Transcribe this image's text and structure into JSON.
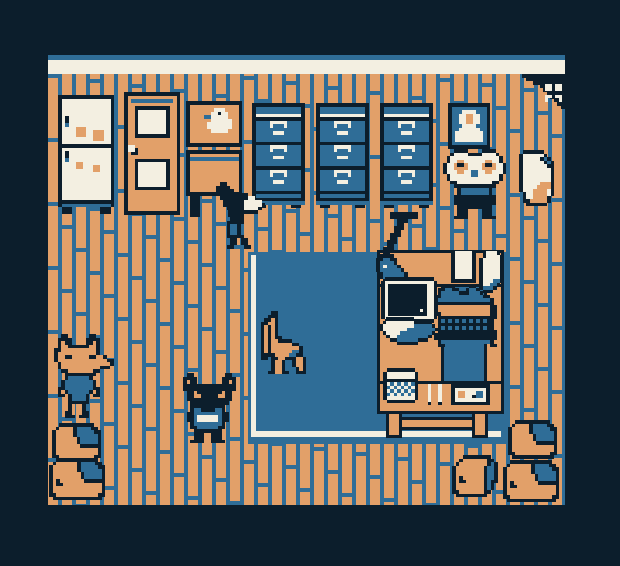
{
  "canvas": {
    "w": 620,
    "h": 566
  },
  "pixel": 3.5,
  "palette": {
    "navy": "#0c1e2c",
    "blue": "#2f6d97",
    "orange": "#e2a069",
    "cream": "#f3efe1"
  },
  "color_keys": {
    "N": "navy",
    "B": "blue",
    "O": "orange",
    "C": "cream"
  },
  "room": {
    "left": 48,
    "top": 74,
    "right": 565,
    "bottom": 505
  },
  "scene": [
    {
      "name": "wall-trim-top",
      "type": "rect",
      "x": 48,
      "y": 55,
      "w": 517,
      "h": 5,
      "color": "blue",
      "interactable": false
    },
    {
      "name": "wall-trim",
      "type": "rect",
      "x": 48,
      "y": 60,
      "w": 517,
      "h": 14,
      "color": "cream",
      "interactable": false
    },
    {
      "name": "floor",
      "type": "floor",
      "x": 48,
      "y": 74,
      "w": 517,
      "h": 431,
      "plank": 10,
      "gap": 4,
      "seam": 4,
      "len": 64,
      "phase": 23,
      "interactable": false
    },
    {
      "name": "corner-shadow",
      "type": "sprite",
      "sprite": "corner_shadow",
      "x": 522,
      "y": 74,
      "interactable": false
    },
    {
      "name": "moth",
      "type": "sprite",
      "sprite": "moth",
      "x": 541,
      "y": 84,
      "interactable": true
    },
    {
      "name": "rug",
      "type": "rects",
      "interactable": false,
      "parts": [
        {
          "name": "rug-base",
          "x": 248,
          "y": 252,
          "w": 258,
          "h": 192,
          "color": "blue"
        },
        {
          "name": "rug-border-left",
          "x": 251,
          "y": 255,
          "w": 5,
          "h": 177,
          "color": "cream"
        },
        {
          "name": "rug-border-bottom",
          "x": 251,
          "y": 431,
          "w": 250,
          "h": 6,
          "color": "cream"
        }
      ]
    },
    {
      "name": "fridge",
      "type": "sprite",
      "sprite": "fridge",
      "x": 58,
      "y": 95,
      "interactable": true
    },
    {
      "name": "door",
      "type": "sprite",
      "sprite": "door",
      "x": 124,
      "y": 92,
      "interactable": true
    },
    {
      "name": "side-table",
      "type": "sprite",
      "sprite": "side_table",
      "x": 186,
      "y": 150,
      "interactable": true
    },
    {
      "name": "goose-picture",
      "type": "sprite",
      "sprite": "duck_picture",
      "x": 186,
      "y": 101,
      "interactable": false
    },
    {
      "name": "file-cabinet-1",
      "type": "sprite",
      "sprite": "file_cabinet",
      "x": 252,
      "y": 103,
      "interactable": true
    },
    {
      "name": "file-cabinet-2",
      "type": "sprite",
      "sprite": "file_cabinet",
      "x": 316,
      "y": 103,
      "interactable": true
    },
    {
      "name": "file-cabinet-3",
      "type": "sprite",
      "sprite": "file_cabinet",
      "x": 380,
      "y": 103,
      "interactable": true
    },
    {
      "name": "portrait",
      "type": "sprite",
      "sprite": "portrait",
      "x": 448,
      "y": 103,
      "interactable": false
    },
    {
      "name": "rabbit-character",
      "type": "sprite",
      "sprite": "rabbit",
      "x": 443,
      "y": 149,
      "interactable": true
    },
    {
      "name": "paper-bag",
      "type": "sprite",
      "sprite": "paper_bag",
      "x": 519,
      "y": 150,
      "interactable": true
    },
    {
      "name": "sniffing-cat-character",
      "type": "sprite",
      "sprite": "sniff_cat",
      "x": 216,
      "y": 182,
      "interactable": true
    },
    {
      "name": "chair",
      "type": "sprite",
      "sprite": "chair",
      "x": 257,
      "y": 311,
      "interactable": true
    },
    {
      "name": "desk-footbar",
      "type": "brect",
      "x": 398,
      "y": 417,
      "w": 78,
      "h": 13,
      "interactable": false
    },
    {
      "name": "desk-leg-left",
      "type": "brect",
      "x": 386,
      "y": 411,
      "w": 16,
      "h": 27,
      "interactable": false
    },
    {
      "name": "desk-leg-right",
      "type": "brect",
      "x": 472,
      "y": 411,
      "w": 16,
      "h": 27,
      "interactable": false
    },
    {
      "name": "desk-top",
      "type": "brect",
      "x": 377,
      "y": 250,
      "w": 127,
      "h": 37,
      "interactable": true
    },
    {
      "name": "desk-left-arm",
      "type": "brect",
      "x": 377,
      "y": 284,
      "w": 67,
      "h": 100,
      "interactable": true
    },
    {
      "name": "desk-right-arm",
      "type": "brect",
      "x": 484,
      "y": 284,
      "w": 20,
      "h": 100,
      "interactable": true
    },
    {
      "name": "desk-bottom",
      "type": "brect",
      "x": 377,
      "y": 381,
      "w": 127,
      "h": 33,
      "interactable": true
    },
    {
      "name": "desk-lamp",
      "type": "sprite",
      "sprite": "lamp",
      "x": 376,
      "y": 212,
      "interactable": true
    },
    {
      "name": "papers",
      "type": "sprite",
      "sprite": "papers",
      "x": 451,
      "y": 251,
      "interactable": false
    },
    {
      "name": "monitor",
      "type": "sprite",
      "sprite": "monitor",
      "x": 381,
      "y": 277,
      "interactable": true
    },
    {
      "name": "open-book",
      "type": "sprite",
      "sprite": "book",
      "x": 379,
      "y": 317,
      "interactable": false
    },
    {
      "name": "typewriter",
      "type": "sprite",
      "sprite": "typewriter",
      "x": 434,
      "y": 284,
      "interactable": true
    },
    {
      "name": "mug",
      "type": "sprite",
      "sprite": "mug",
      "x": 383,
      "y": 368,
      "interactable": false
    },
    {
      "name": "pencils",
      "type": "sprite",
      "sprite": "pencils",
      "x": 424,
      "y": 384,
      "interactable": false
    },
    {
      "name": "cassette",
      "type": "sprite",
      "sprite": "cassette",
      "x": 451,
      "y": 384,
      "interactable": false
    },
    {
      "name": "fox-character",
      "type": "sprite",
      "sprite": "fox",
      "x": 54,
      "y": 334,
      "interactable": true
    },
    {
      "name": "black-cat-character",
      "type": "sprite",
      "sprite": "black_cat",
      "x": 183,
      "y": 373,
      "interactable": true
    },
    {
      "name": "box-stack-left-top",
      "type": "sprite",
      "sprite": "box",
      "x": 52,
      "y": 423,
      "interactable": true
    },
    {
      "name": "box-stack-left-bottom",
      "type": "sprite",
      "sprite": "box_big",
      "x": 49,
      "y": 458,
      "interactable": true
    },
    {
      "name": "box-stack-right-top",
      "type": "sprite",
      "sprite": "box",
      "x": 508,
      "y": 420,
      "interactable": true
    },
    {
      "name": "box-stack-right-bottom",
      "type": "sprite",
      "sprite": "box_big",
      "x": 503,
      "y": 460,
      "interactable": true
    },
    {
      "name": "box-small-right",
      "type": "sprite",
      "sprite": "box_small",
      "x": 452,
      "y": 455,
      "interactable": true
    }
  ],
  "sprites": {
    "fridge": [
      "NNNNNNNNNNNNNNNN",
      "NCCCCCCCCCCCCCCN",
      "NCCCCCCCCCCCCCCN",
      "NCCCCCCCCCCCCCCN",
      "NCCCCCCCCCCCCCCN",
      "NCCCCCCCCCCCCCCN",
      "NCNCCCCCCCCCCCCN",
      "NCNCCCCCCCCCCCCN",
      "NCBCCCCCCCCCCCCN",
      "NCCCCOOOCCCCCCCN",
      "NCCCCOOOCCOOOCCN",
      "NCCCCOOOCCOOOCCN",
      "NCCCCCCCCCOOOCCN",
      "NCCCCCCCCCCCCCCN",
      "NNNNNNNNNNNNNNNN",
      "NCCCCCCCCCCCCCCN",
      "NCNCCCCCCCCCCCCN",
      "NCNCCCCCCCCCCCCN",
      "NCBCCCCCCCCCCCCN",
      "NCCCCOOCCCCCCCCN",
      "NCCCCOOCCCOOCCCN",
      "NCCCCCCCCCOOCCCN",
      "NCCCCCCCCCCCCCCN",
      "NCCCCCCCCCCCCCCN",
      "NCCCCCCCCCCCCCCN",
      "NCCCCCCCCCCCCCCN",
      "NCCCCCCCCCCCCCCN",
      "NCCCCCCCCCCCCCCN",
      "NCCCCCCCCCCCCCCN",
      "NCCCCCCCCCCCCCCN",
      "NNNNNNNNNNNNNNNN",
      "NBBBBBBBBBBBBBBN",
      ".NNN........NNN.",
      ".NNN........NNN."
    ],
    "door": [
      "NNNNNNNNNNNNNNNN",
      "NOOOOOOOOOOOOOON",
      "NOBBBBBBBBBBBBON",
      "NOOOOOOOOOOOOOON",
      "NOONNNNNNNNNNOON",
      "NOONCCCCCCCCNOON",
      "NOONCCCCCCCCNOON",
      "NOONCCCCCCCCNOON",
      "NOONCCCCCCCCNOON",
      "NOONCCCCCCCCNOON",
      "NOONCCCCCCCCNOON",
      "NOONCCCCCCCCNOON",
      "NOONNNNNNNNNNOON",
      "NOOOOOOOOOOOOOON",
      "NOOOOOOOOOOOOOON",
      "NCCOOOOOOOOOOOON",
      "NCCNOOOOOOOOOOON",
      "NONNOOOOOOOOOOON",
      "NOOOOOOOOOOOOOON",
      "NOONNNNNNNNNNOON",
      "NOONCCCCCCCCNOON",
      "NOONCCCCCCCCNOON",
      "NOONCCCCCCCCNOON",
      "NOONCCCCCCCCNOON",
      "NOONCCCCCCCCNOON",
      "NOONCCCCCCCCNOON",
      "NOONCCCCCCCCNOON",
      "NOONNNNNNNNNNOON",
      "NOOOOOOOOOOOOOON",
      "NOOOOOOOOOOOOOON",
      "NOOOOOOOOOOOOOON",
      "NOOOOOOOOOOOOOON",
      "NOOOOOOOOOOOOOON",
      "NOOOOOOOOOOOOOON",
      "NNNNNNNNNNNNNNNN"
    ],
    "duck_picture": [
      "NNNNNNNNNNNNNNNN",
      "NOOOOOOOOOOOOOON",
      "NOOOOOOOCCCOOOON",
      "NOOOOOOCCNCCOOON",
      "NOOOOBBCCCCCOOON",
      "NOOOOOOCCCCCCOON",
      "NOOOOOCCCCCCCOON",
      "NOOOOOCCCCCCCOON",
      "NOOOOOOCCCCCOOON",
      "NOOOOOOOOOOOOOON",
      "NOOOOOOOOOOOOOON",
      "NOOOOOOOOOOOOOON",
      "NNNNNNNNNNNNNNNN"
    ],
    "side_table": [
      "NNNNNNNNNNNNNNNN",
      "NOOOOOOOOOOOOOON",
      "NBBBBBBBBBBBBBBN",
      "NOOOOOOOOOOOOOON",
      "NOOOOOOOOOOOOOON",
      "NOOOOOOOOOOOOOON",
      "NOOOOOOOOOOOOOON",
      "NOOOOOOOOOOOOOON",
      "NOOOOOOOOOOOOOON",
      "NOOOOOOOOOOOOOON",
      "NOOOOOOOOOOOOOON",
      "NOOOOOOOOOOOOOON",
      "NNNNNNNNNNNNNNNN",
      ".NNN........NNN.",
      ".NNN........NNN.",
      ".NNN........NNN.",
      ".NNN........NNN.",
      ".NNN........NNN.",
      ".NNN........NNN."
    ],
    "file_cabinet": [
      "NNNNNNNNNNNNNNN",
      "NBBBBBBBBBBBBBN",
      "NBBBBBBBBBBBBBN",
      "NCCCCCCCCCCCCCN",
      "NNNNNNNNNNNNNNN",
      "NBBBBCCCCCBBBBN",
      "NBBBBCBBBCBBBBN",
      "NBBBBBBBBBBBBBN",
      "NBBBBBCCCBBBBBN",
      "NBBBBBBBBBBBBBN",
      "NBBBBBBBBBBBBBN",
      "NNNNNNNNNNNNNNN",
      "NBBBBCCCCCBBBBN",
      "NBBBBCBBBCBBBBN",
      "NBBBBBBBBBBBBBN",
      "NBBBBBCCCBBBBBN",
      "NBBBBBBBBBBBBBN",
      "NBBBBBBBBBBBBBN",
      "NNNNNNNNNNNNNNN",
      "NBBBBCCCCCBBBBN",
      "NBBBBCBBBCBBBBN",
      "NBBBBBBBBBBBBBN",
      "NBBBBBCCCBBBBBN",
      "NBBBBBBBBBBBBBN",
      "NBBBBBBBBBBBBBN",
      "NNNNNNNNNNNNNNN",
      "NBBBBBBBBBBBBBN",
      "NNNNNNNNNNNNNNN",
      "BBBBBBBBBBBBBBB",
      ".NNN.......NNN."
    ],
    "portrait": [
      "NNNNNNNNNNNN",
      "NBBBBBBBBBBN",
      "NBBBCCCCBBBN",
      "NBBCCOOCCBBN",
      "NBBCCOOCCBBN",
      "NBBCCOOCCBBN",
      "NBBBCCCCBBBN",
      "NBBCCCCCCBBN",
      "NBCCCCCCCCBN",
      "NBCCCCCCCCBN",
      "NBCCCCCCCCBN",
      "NBBBBBBBBBBN",
      "NNNNNNNNNNNN"
    ],
    "rabbit": [
      "...NNNN....NNNN...",
      "..NCCCCNNNNCCCCN..",
      ".NCCCCCCCCCCCCCCN.",
      ".NCCOOCCCCCCOOCCN.",
      "NCCONNOCCCCONNOCCN",
      "NCCOOOOCCCCOOOOCCN",
      "NCCCOOCCBBCCOOCCCN",
      ".NCCCCCCBBCCCCCCN.",
      ".NCCCCCCCCCCCCCCN.",
      "..NNCCCCCCCCCCNN..",
      "...NNNNNNNNNNNN...",
      "....NBBBBBBBBN....",
      "....NBBBBBBBBN....",
      "...NNNNNNNNNNNN...",
      "...NNNNNNNNNNNN...",
      "...NNNNNNNNNNNN...",
      "....NNNNNNNNNN....",
      "....NNN....NNN....",
      "....NNN....NNN....",
      "...NNNN....NNNN..."
    ],
    "paper_bag": [
      ".NNNNNN....",
      "NCCCCCCN...",
      "NCCCCCNBN..",
      "NCCCCCCNBN.",
      "NCCCCCCCNN.",
      "NCCCCCCCCN.",
      "NCCCCCCCCN.",
      "NCCCCCCCCN.",
      "NCCCCCCCCN.",
      "NCCCCCOOON.",
      "NCCCCOOOON.",
      "NCCCOOOOCN.",
      ".NCCOOOOCN.",
      ".NCCOOOON..",
      ".NNOOOOON..",
      "..NNNNNN..."
    ],
    "sniff_cat": [
      ".NN...........",
      "NNNN..........",
      "NNNNN.........",
      ".NNNNNNNN.....",
      ".NNNNNNNNCC...",
      "..NNNNNNCCCCC.",
      "..NNNNNNCCCCCN",
      "...NNNNNCCCCN.",
      "....NNNNNNNN..",
      "....NNNN......",
      "....NNNN......",
      "...NNNNN......",
      "...NBBN.......",
      "...NBBN.......",
      "...NBBN.......",
      "...NNNNN......",
      "....NN.NN.....",
      "....NN.NN.....",
      "...NN...NN...."
    ],
    "chair": [
      "....NN.........",
      "...NNN.........",
      "..NNON.........",
      ".NNOON.........",
      ".NONON.........",
      ".NONON.........",
      ".NONON.........",
      ".NONONN........",
      ".NONOONNNN.....",
      ".NONOOOOOONN...",
      ".NONOOOOOOOON..",
      ".NONOOOOOOBBN..",
      ".NNNNOOOOBBNN..",
      ".NN.NNOONNNOON.",
      "....NOON..NOON.",
      "....NOON..NOON.",
      "....NOON...NON.",
      "...NNOONN..NNN."
    ],
    "lamp": [
      "....NNNNNNNN..",
      "....NNNNNNNN..",
      "......NNN.....",
      "......NN......",
      ".....NNN......",
      ".....NN.......",
      "....NNN.......",
      "....NN........",
      "...NNN........",
      "...NN.........",
      "..NNN.........",
      "..NN..........",
      ".NNNN.........",
      "NNBBNN........",
      "NBBBBN........",
      "NBCBBBN.......",
      "NBBBBBBN......",
      ".NBBBBBBN.....",
      ".NBBBBBBN.....",
      "..NBBBBNN.....",
      "..NNNNNN......"
    ],
    "papers": [
      "NCCCCCN..NCCCN.",
      "NCCCCCN..NCCCCN",
      "NCCCCCN.NCCCCCN",
      "NCCCCCN.NCCCCCN",
      "NCCCCCN.NCCCCCN",
      "NCCCCCN.NCCCCCN",
      "NCCCCCN.NCCCCCN",
      "NCCCCCN.NCCCCCN",
      "NNNNNNN.NCCCBBN",
      "........NCCBBN.",
      "........NBBBN..",
      ".........NNN..."
    ],
    "monitor": [
      ".NNNNNNNNNNNNNN...",
      "NCCCCCCCCCCCCCCN..",
      "NCNNNNNNNNNNNCCN..",
      "NCNNNNNNNNNNNCCN..",
      "NCNNNNNNNNNNNCCN..",
      "NCNNNNNNNNNNNCCN..",
      "NCNNNNNNNNNNNCCN..",
      "NCNNNNNNNNNNNCCN..",
      "NCNNNNNNNNNNNCCN..",
      "NCNNNNNNNNNCNCCN..",
      "NCNNNNNNNNNNNCCN..",
      "NCCCCCCCCCCCCCCN..",
      ".NNNNNNNNNNNNNN...",
      "......NCCN........",
      "....NNCCCCNN......"
    ],
    "book": [
      "..NNNNNNNN.........",
      ".NCCCCCCCCNNNNN....",
      "NCCCCCCCCCBBBBBN...",
      "NCCCCCCCBBBBBBBBN..",
      ".NCCCCBBBBBBBBBN...",
      "..NCCBBBBBBBBBN....",
      "...NNBBBBBBNNN.....",
      ".....NNNNNN........"
    ],
    "typewriter": [
      "..NNNN....NN.......",
      ".NNBBNN..NBBN......",
      ".NBBBBBNNNBBBN.....",
      "NNBBBBBBBBBBBBNN...",
      "NBBBBBBBBBBBBBBBN..",
      "NNNNNNNNNNNNNNNNN..",
      "NOOOOOOOOOOOOOOONN.",
      "NOOOOOOOOOOOOOOONN.",
      "NNOOOOOOOOOOOOOONN.",
      ".NNNNNNNNNNNNNNNNN.",
      ".NBNBNBNBNBNBNBNN..",
      ".NNNNNNNNNNNNNNNN..",
      ".NBNBNBNBNBNBNBNN..",
      ".NNNNNNNNNNNNNNNNN.",
      "NNNNNNNNNNNNNNNNNN.",
      "NNNNNNNNNNNNNNNNNN.",
      ".NBBBBBBBBBBBBBBN..",
      ".NN.............NN."
    ],
    "mug": [
      ".NNNNNNNN..",
      "NCCCCCCCCN.",
      "NCCCCCCCCN.",
      "NNNNNNNNNN.",
      "NCBCBCBCBN.",
      "NBCBCBCBCN.",
      "NCBCBCBCBN.",
      "NBCBCBCBCN.",
      "NCCCCCCCCN.",
      ".NNNNNNNN.."
    ],
    "pencils": [
      ".C..C.",
      ".C..C.",
      ".C..C.",
      ".C..C.",
      ".C..C.",
      ".N..N."
    ],
    "cassette": [
      "NNNNNNNNNNN",
      "NCCCCCCCCCN",
      "NCOOCCCBBCN",
      "NCOOCCNBBCN",
      "NCCCCCCCCCN",
      "NNNNNNNNNNN"
    ],
    "fox": [
      "..NN......NN.....",
      ".NNNN....NNNN....",
      ".NONN....NNON....",
      ".NOONNNNNNOON....",
      "NNOOOOOOOOOON....",
      "NOOOOOOOOOOON....",
      "NOONNOOOOONNOON..",
      "NOOOOOOOOOOOOOONN",
      ".NOOOOOOOOOOOOOON",
      ".NOOOOOOOOOOONNN.",
      "..NNOOOOOOONN....",
      "...NNNNNNNNN.....",
      "...NBBBBBBN......",
      "..NBBBBBBBBN.....",
      "..NBBBBBBBBN.....",
      ".NNBBBBBBBBNN....",
      ".NONBBBBBBNON....",
      ".NN.NBBBBN.NN....",
      "....NBBBBN.......",
      "....NNNNNN.......",
      "....NO.ON........",
      "....NO.ON........",
      "...NNO.ONN.......",
      "...NNN.NNN......."
    ],
    "black_cat": [
      ".NN.........NN..",
      "NNNN.......NNNN.",
      "NONN.......NNON.",
      "NNNNNNNNNNNNNNN.",
      "NNNNNNNNNNNNNNN.",
      ".NNONNNNNNNONN..",
      ".NNOONNNNNOONN..",
      ".NNNNNNNNNNNNN..",
      "..NNNNNNNNNNN...",
      "..NNNNNNNNNN....",
      "..NBBNNNNBBN....",
      ".NNBBBBBBBBNN...",
      ".NNBCCCCCCBNN...",
      ".NNBCCCCCCBNN...",
      "..NBBBBBBBBN....",
      "..NNBBBBBBNN....",
      "...NNNNNNNN.....",
      "...NNN..NNN.....",
      "...NNN..NNN.....",
      "..NNNN..NNNN...."
    ],
    "box": [
      "..NNNNNNNNNN...",
      ".NOOOONBBBBNN..",
      "NOOOOONBBBBBNN.",
      "NOOOOONBBBBBBN.",
      "NOOOOOONBBBBBN.",
      "NOOOOOONBBBBBN.",
      "NOOOOOOONNNNNN.",
      "NOOOOOOOOOOOON.",
      "NOOOOOOOOOOOON.",
      "NNOOOOOOOOOONN.",
      ".NNNNNNNNNNNN.."
    ],
    "box_big": [
      "..NNNNNNNNNNNN...",
      ".NOOOOOONBBBBNN..",
      "NOOOOOOONBBBBBNN.",
      "NOOOOOOONBBBBBBN.",
      "NOOOOOOOONBBBBBN.",
      "NOOOOOOOONBBBBBN.",
      "NONOOOOOOONNNNNN.",
      "NONNOOOOOOOOOOON.",
      "NOOOOOOOOOOOOOON.",
      "NOOOOOOOOOOOOOON.",
      "NNOOOOOOOOOOOONN.",
      ".NNNNNNNNNNNNNN.."
    ],
    "box_small": [
      "...NNNNNNNN...",
      "..NOOOOOOONN..",
      ".NOOOOOOOONBN.",
      "NOOOOOOOONBBN.",
      "NOOOOOOOONBBN.",
      "NOOOOOOOONBBN.",
      "NONOOOOOONBBN.",
      "NONNOOOOONBNN.",
      "NOOOOOOOONBN..",
      "NOOOOOOOONBN..",
      "NNOOOOOOONN...",
      ".NNNNNNNNN...."
    ],
    "moth": [
      ".CC.CC.",
      ".CCNCC.",
      "..NNN..",
      ".CCNCC.",
      ".C...C."
    ],
    "corner_shadow": [
      "NNNNNNNNNNNNN",
      ".NNNNNNNNNNNN",
      "...NNNNNNNNNN",
      ".....NNNNNNNN",
      "......NNNNNNN",
      ".......NNNNNN",
      "........NNNNN",
      ".........NNNN",
      "..........NNN",
      "...........NN"
    ]
  }
}
